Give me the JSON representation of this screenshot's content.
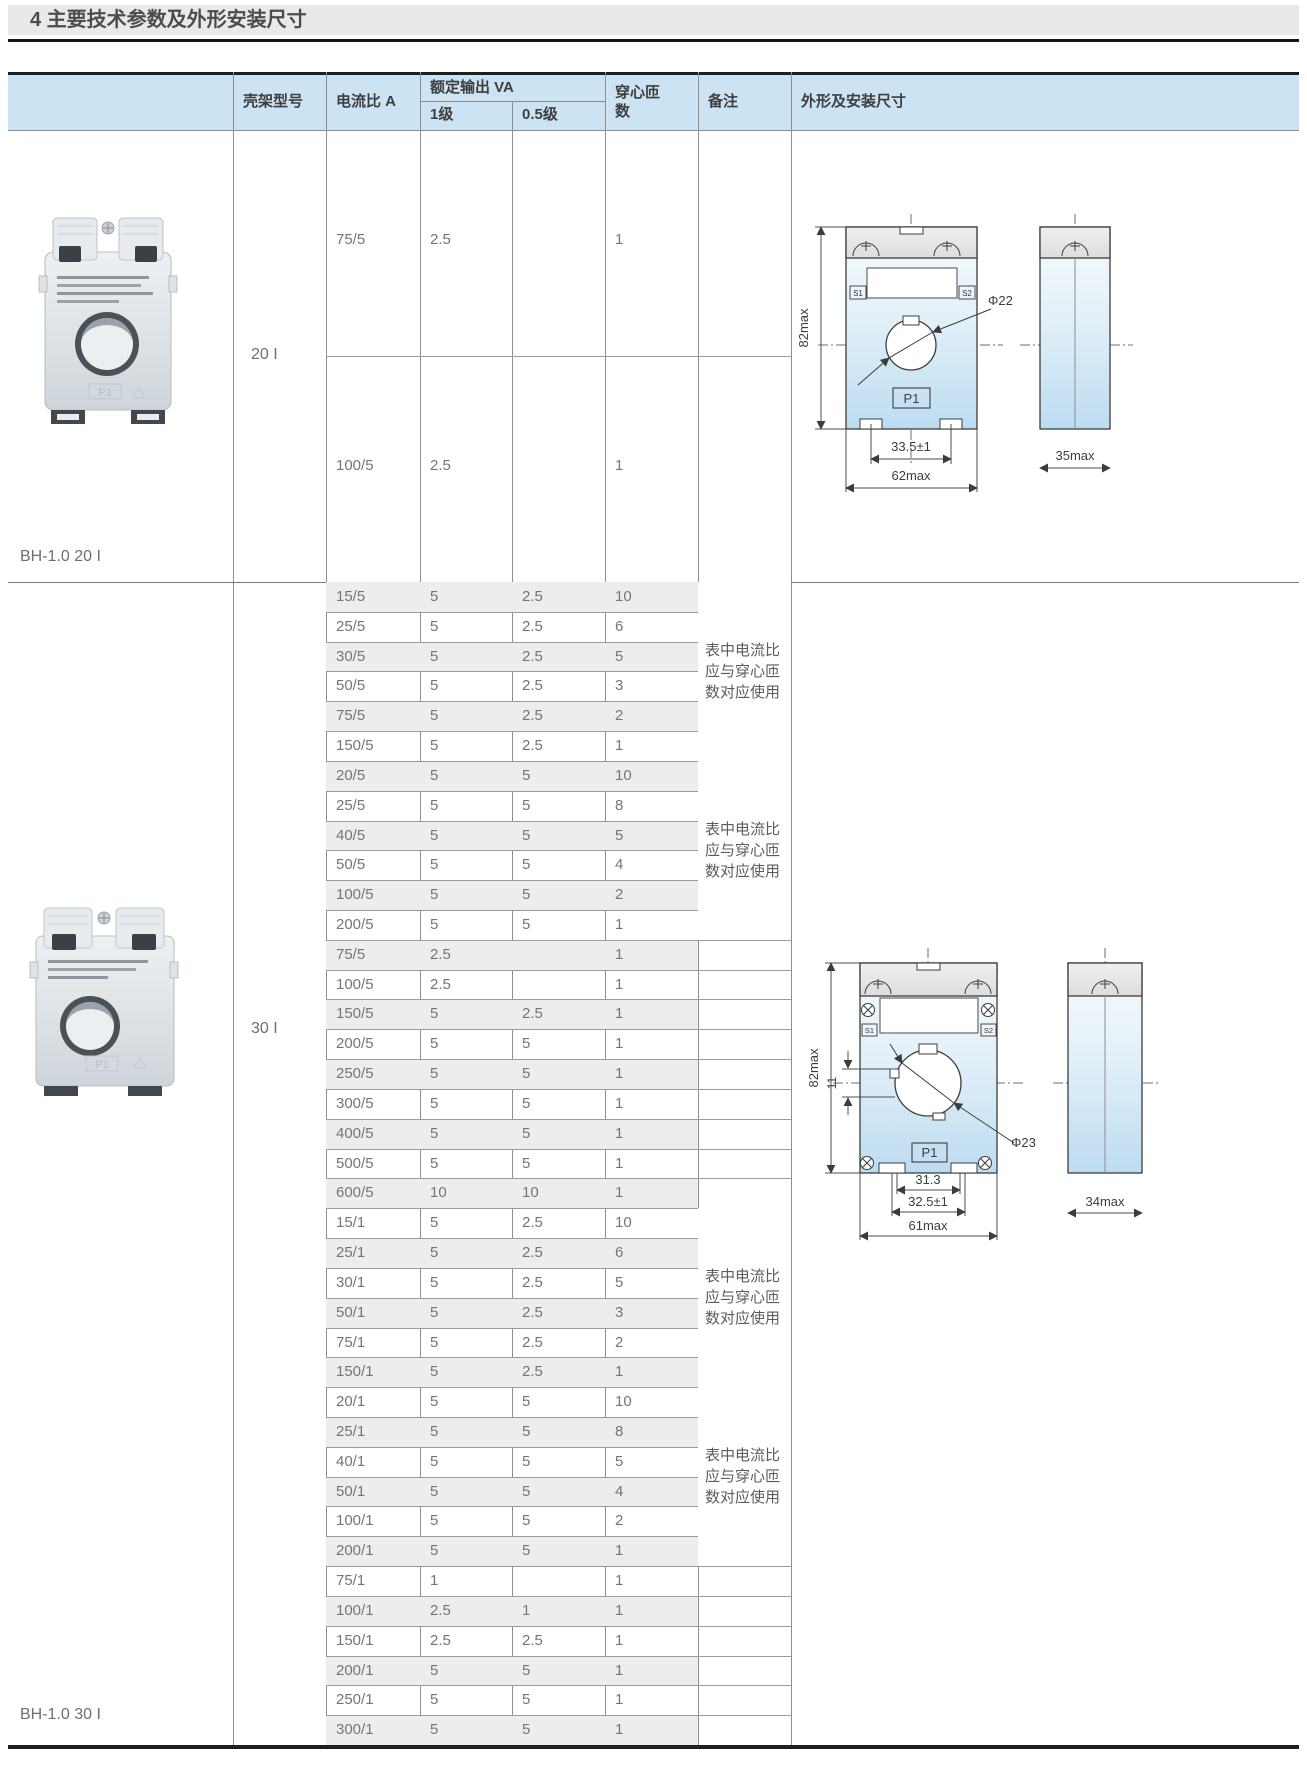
{
  "page": {
    "title": "4 主要技术参数及外形安装尺寸"
  },
  "colors": {
    "header_blue": "#cbe3f2",
    "zebra_gray": "#ededed",
    "rule_dark": "#1f1f1f",
    "drawing_blue_top": "#f5fafd",
    "drawing_blue_bottom": "#bddcf1"
  },
  "table": {
    "headers": {
      "frame_model": "壳架型号",
      "current_ratio": "电流比 A",
      "rated_output": "额定输出 VA",
      "class_1": "1级",
      "class_05": "0.5级",
      "turns": "穿心匝数",
      "remarks": "备注",
      "outline": "外形及安装尺寸"
    },
    "remark_text": "表中电流比应与穿心匝数对应使用",
    "sections": [
      {
        "model": "20 I",
        "photo_label": "BH-1.0 20 I",
        "rows": [
          {
            "ratio": "75/5",
            "va1": "2.5",
            "va05": "",
            "turns": "1"
          },
          {
            "ratio": "100/5",
            "va1": "2.5",
            "va05": "",
            "turns": "1"
          }
        ]
      },
      {
        "model": "30 I",
        "photo_label": "BH-1.0 30 I",
        "rows": [
          {
            "ratio": "15/5",
            "va1": "5",
            "va05": "2.5",
            "turns": "10"
          },
          {
            "ratio": "25/5",
            "va1": "5",
            "va05": "2.5",
            "turns": "6"
          },
          {
            "ratio": "30/5",
            "va1": "5",
            "va05": "2.5",
            "turns": "5"
          },
          {
            "ratio": "50/5",
            "va1": "5",
            "va05": "2.5",
            "turns": "3"
          },
          {
            "ratio": "75/5",
            "va1": "5",
            "va05": "2.5",
            "turns": "2"
          },
          {
            "ratio": "150/5",
            "va1": "5",
            "va05": "2.5",
            "turns": "1"
          },
          {
            "ratio": "20/5",
            "va1": "5",
            "va05": "5",
            "turns": "10"
          },
          {
            "ratio": "25/5",
            "va1": "5",
            "va05": "5",
            "turns": "8"
          },
          {
            "ratio": "40/5",
            "va1": "5",
            "va05": "5",
            "turns": "5"
          },
          {
            "ratio": "50/5",
            "va1": "5",
            "va05": "5",
            "turns": "4"
          },
          {
            "ratio": "100/5",
            "va1": "5",
            "va05": "5",
            "turns": "2"
          },
          {
            "ratio": "200/5",
            "va1": "5",
            "va05": "5",
            "turns": "1"
          },
          {
            "ratio": "75/5",
            "va1": "2.5",
            "va05": "",
            "turns": "1"
          },
          {
            "ratio": "100/5",
            "va1": "2.5",
            "va05": "",
            "turns": "1"
          },
          {
            "ratio": "150/5",
            "va1": "5",
            "va05": "2.5",
            "turns": "1"
          },
          {
            "ratio": "200/5",
            "va1": "5",
            "va05": "5",
            "turns": "1"
          },
          {
            "ratio": "250/5",
            "va1": "5",
            "va05": "5",
            "turns": "1"
          },
          {
            "ratio": "300/5",
            "va1": "5",
            "va05": "5",
            "turns": "1"
          },
          {
            "ratio": "400/5",
            "va1": "5",
            "va05": "5",
            "turns": "1"
          },
          {
            "ratio": "500/5",
            "va1": "5",
            "va05": "5",
            "turns": "1"
          },
          {
            "ratio": "600/5",
            "va1": "10",
            "va05": "10",
            "turns": "1"
          },
          {
            "ratio": "15/1",
            "va1": "5",
            "va05": "2.5",
            "turns": "10"
          },
          {
            "ratio": "25/1",
            "va1": "5",
            "va05": "2.5",
            "turns": "6"
          },
          {
            "ratio": "30/1",
            "va1": "5",
            "va05": "2.5",
            "turns": "5"
          },
          {
            "ratio": "50/1",
            "va1": "5",
            "va05": "2.5",
            "turns": "3"
          },
          {
            "ratio": "75/1",
            "va1": "5",
            "va05": "2.5",
            "turns": "2"
          },
          {
            "ratio": "150/1",
            "va1": "5",
            "va05": "2.5",
            "turns": "1"
          },
          {
            "ratio": "20/1",
            "va1": "5",
            "va05": "5",
            "turns": "10"
          },
          {
            "ratio": "25/1",
            "va1": "5",
            "va05": "5",
            "turns": "8"
          },
          {
            "ratio": "40/1",
            "va1": "5",
            "va05": "5",
            "turns": "5"
          },
          {
            "ratio": "50/1",
            "va1": "5",
            "va05": "5",
            "turns": "4"
          },
          {
            "ratio": "100/1",
            "va1": "5",
            "va05": "5",
            "turns": "2"
          },
          {
            "ratio": "200/1",
            "va1": "5",
            "va05": "5",
            "turns": "1"
          },
          {
            "ratio": "75/1",
            "va1": "1",
            "va05": "",
            "turns": "1"
          },
          {
            "ratio": "100/1",
            "va1": "2.5",
            "va05": "1",
            "turns": "1"
          },
          {
            "ratio": "150/1",
            "va1": "2.5",
            "va05": "2.5",
            "turns": "1"
          },
          {
            "ratio": "200/1",
            "va1": "5",
            "va05": "5",
            "turns": "1"
          },
          {
            "ratio": "250/1",
            "va1": "5",
            "va05": "5",
            "turns": "1"
          },
          {
            "ratio": "300/1",
            "va1": "5",
            "va05": "5",
            "turns": "1"
          }
        ],
        "remark_groups": [
          {
            "start": 0,
            "count": 6,
            "has_text": true
          },
          {
            "start": 6,
            "count": 6,
            "has_text": true
          },
          {
            "start": 12,
            "count": 9,
            "has_text": false
          },
          {
            "start": 21,
            "count": 6,
            "has_text": true
          },
          {
            "start": 27,
            "count": 6,
            "has_text": true
          },
          {
            "start": 33,
            "count": 6,
            "has_text": false
          }
        ]
      }
    ]
  },
  "photo": {
    "p1_marking": "P1"
  },
  "drawing_20i": {
    "height_dim": "82max",
    "hole_dim": "Φ22",
    "feet_dim": "33.5±1",
    "width_dim": "62max",
    "side_width_dim": "35max",
    "label_p1": "P1",
    "label_s1": "S1",
    "label_s2": "S2"
  },
  "drawing_30i": {
    "height_dim": "82max",
    "hole_dim": "Φ23",
    "offset_dim": "11",
    "inner_dim": "31.3",
    "feet_dim": "32.5±1",
    "width_dim": "61max",
    "side_width_dim": "34max",
    "label_p1": "P1",
    "label_s1": "S1",
    "label_s2": "S2"
  }
}
